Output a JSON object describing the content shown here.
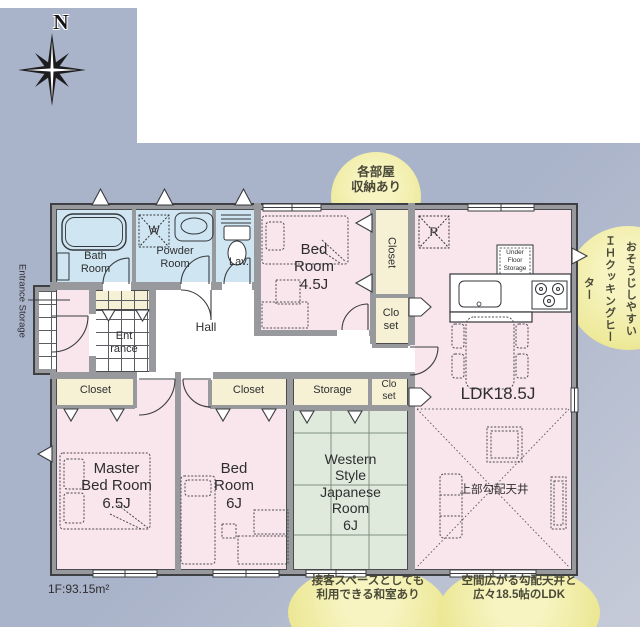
{
  "colors": {
    "bg": "#a9b3c9",
    "bg2": "#c6cbd8",
    "wall": "#97999d",
    "ink": "#2e2e30",
    "pink": "#f9e5ec",
    "blue": "#cfe6f2",
    "cream": "#f6f1d5",
    "tatami": "#dfeadd",
    "bubble1": "#f7f4c2",
    "bubble2": "#e9e488"
  },
  "compass": {
    "north": "N"
  },
  "plan": {
    "rooms": {
      "bath": "Bath\nRoom",
      "powder": "Powder\nRoom",
      "lav": "Lav.",
      "washer": "W",
      "bedroom45": "Bed\nRoom\n4.5J",
      "closet_tall": "Closet",
      "closet_small_upper": "Clo\nset",
      "hall": "Hall",
      "entrance": "Ent\nrance",
      "entrance_storage": "Entrance Storage",
      "fridge": "R",
      "underfloor": "Under\nFloor\nStorage",
      "ldk": "LDK18.5J",
      "sloped_ceiling": "上部勾配天井",
      "master": "Master\nBed Room\n6.5J",
      "bedroom6": "Bed\nRoom\n6J",
      "western": "Western\nStyle\nJapanese\nRoom\n6J",
      "closet_master": "Closet",
      "closet_bed6": "Closet",
      "storage": "Storage",
      "closet_small_lower": "Clo\nset"
    },
    "floor_area": "1F:93.15m²"
  },
  "bubbles": {
    "top": "各部屋\n収納あり",
    "right": "おそうじしやすい\nＩＨクッキングヒーター",
    "bottom_left": "接客スペースとしても\n利用できる和室あり",
    "bottom_right": "空間広がる勾配天井と\n広々18.5帖のLDK"
  }
}
